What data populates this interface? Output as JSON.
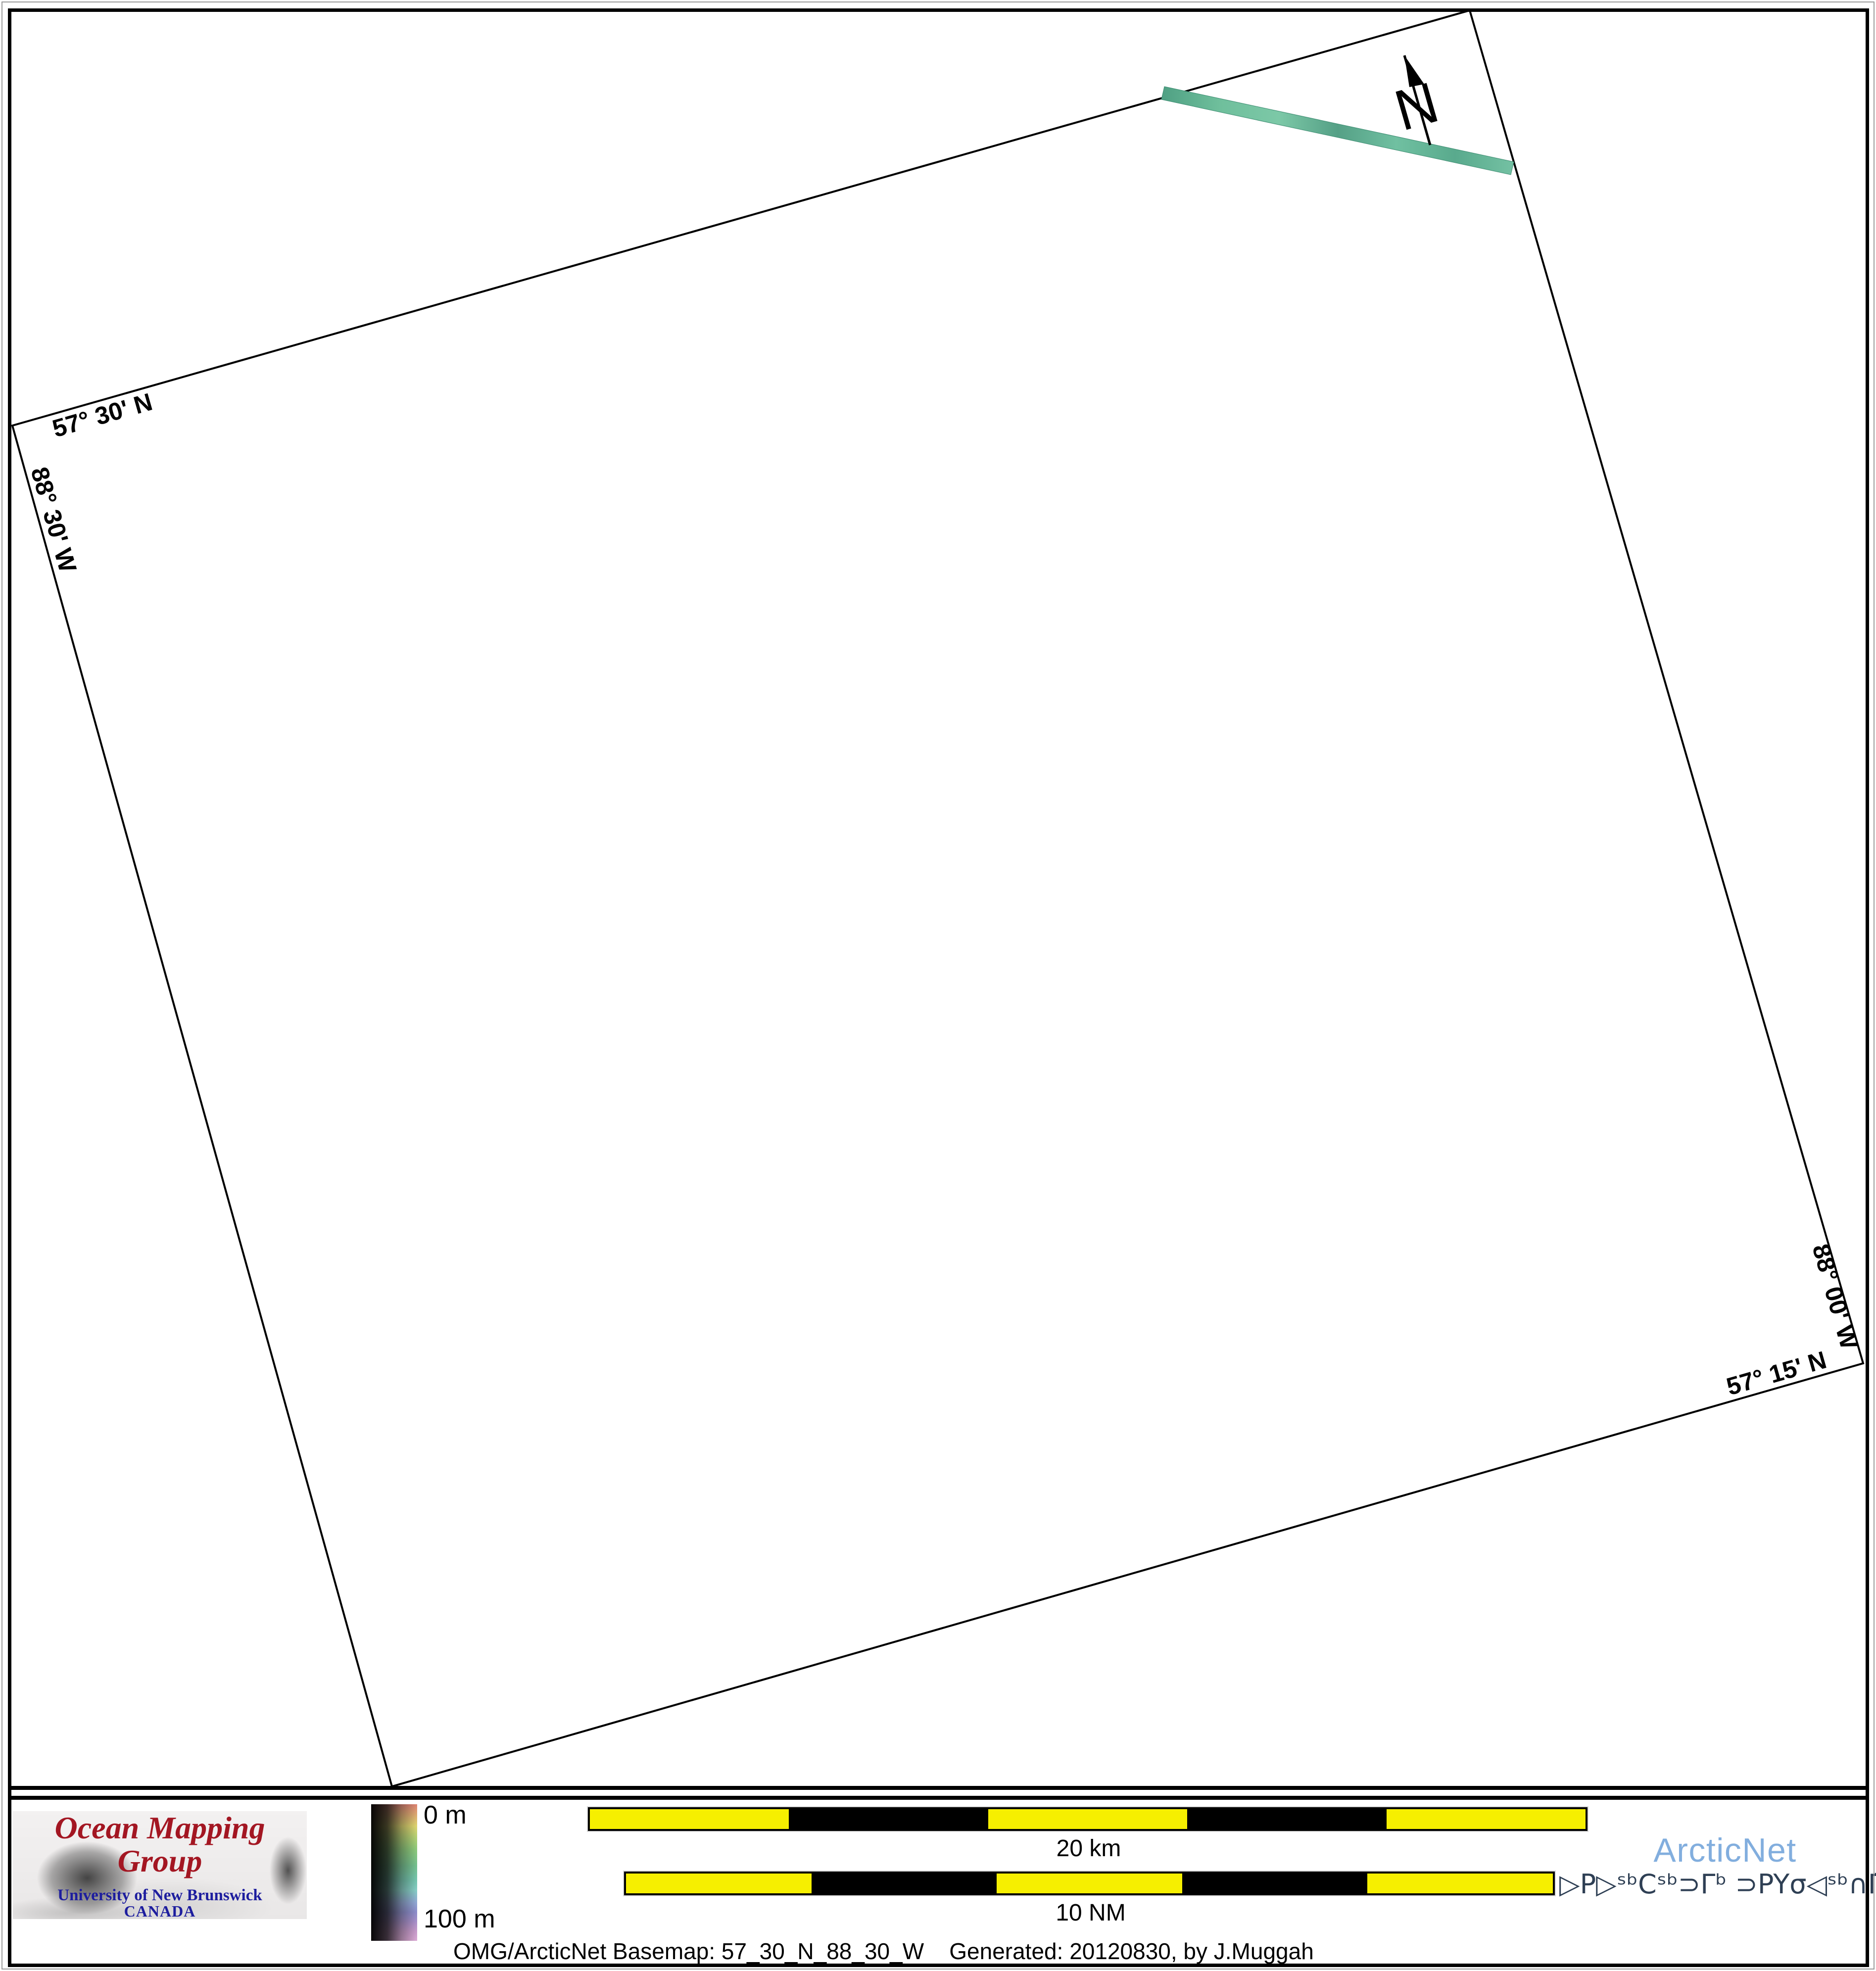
{
  "map": {
    "projection_labels": {
      "top": "57° 30' N",
      "left": "88° 30' W",
      "right": "88° 00' W",
      "bottom": "57° 15' N"
    },
    "north_label": "N",
    "swath_gradient": [
      "#4fa083",
      "#6fbf9c",
      "#7cc8a7",
      "#55a086",
      "#70c0a1",
      "#59aa8d",
      "#74c1a3"
    ]
  },
  "footer": {
    "logo": {
      "title": "Ocean Mapping Group",
      "institution": "University of New Brunswick",
      "country": "CANADA",
      "title_color": "#a31622",
      "institution_color": "#1d1d9e"
    },
    "colorbar": {
      "top_label": "0 m",
      "bottom_label": "100 m",
      "gradient": [
        [
          "#dd8272",
          0
        ],
        [
          "#dcaa70",
          8
        ],
        [
          "#dcd36e",
          16
        ],
        [
          "#b3cf72",
          24
        ],
        [
          "#8cc87a",
          33
        ],
        [
          "#74bf8e",
          45
        ],
        [
          "#74c4ae",
          56
        ],
        [
          "#85ccc4",
          63
        ],
        [
          "#8fa6d2",
          72
        ],
        [
          "#8c8cca",
          79
        ],
        [
          "#a78fc9",
          86
        ],
        [
          "#c79aca",
          93
        ],
        [
          "#daa8d4",
          100
        ]
      ]
    },
    "scalebars": [
      {
        "label": "20 km",
        "segments": [
          "#f6ef00",
          "#000000",
          "#f6ef00",
          "#000000",
          "#f6ef00"
        ]
      },
      {
        "label": "10 NM",
        "segments": [
          "#f6ef00",
          "#000000",
          "#f6ef00",
          "#000000",
          "#f6ef00"
        ]
      }
    ],
    "arcticnet": {
      "name": "ArcticNet",
      "name_color": "#82aede",
      "inuktitut": "▷P▷ˢᵇCˢᵇ⊃Γᵇ ⊃PYσ◁ˢᵇ∩Γ̇ᶜ",
      "inuktitut_color": "#2e3f54"
    },
    "caption": "OMG/ArcticNet Basemap: 57_30_N_88_30_W    Generated: 20120830, by J.Muggah"
  }
}
